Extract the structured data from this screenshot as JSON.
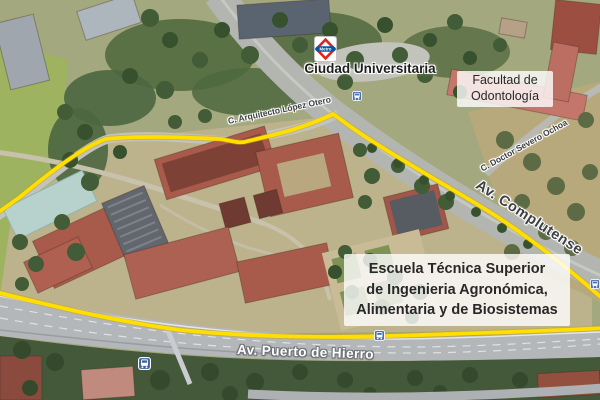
{
  "map": {
    "kind": "aerial-3d-satellite-view",
    "station": {
      "label": "Ciudad Universitaria",
      "logo_word": "Metro"
    },
    "boxes": {
      "faculty": {
        "line1": "Facultad de",
        "line2": "Odontología"
      },
      "school": {
        "line1": "Escuela Técnica Superior",
        "line2": "de Ingenieria Agronómica,",
        "line3": "Alimentaria y de Biosistemas"
      }
    },
    "roads": {
      "arquitecto": "C. Arquitecto López Otero",
      "severo": "C. Doctor Severo Ochoa",
      "complutense": "Av. Complutense",
      "puerto": "Av. Puerto de Hierro"
    },
    "icons": {
      "metro": "metro-logo-icon",
      "bus_stops": [
        "bus-stop-icon",
        "bus-stop-icon",
        "bus-stop-icon",
        "bus-stop-icon"
      ]
    },
    "colors": {
      "route_yellow": "#ffdf00",
      "metro_red": "#e1251b",
      "metro_blue": "#0055a5",
      "bus_blue": "#4a6fae",
      "road_label_dark": "#3d3f42",
      "road_label_light": "#ffffff",
      "annotation_box_bg": "#ffffff"
    }
  }
}
